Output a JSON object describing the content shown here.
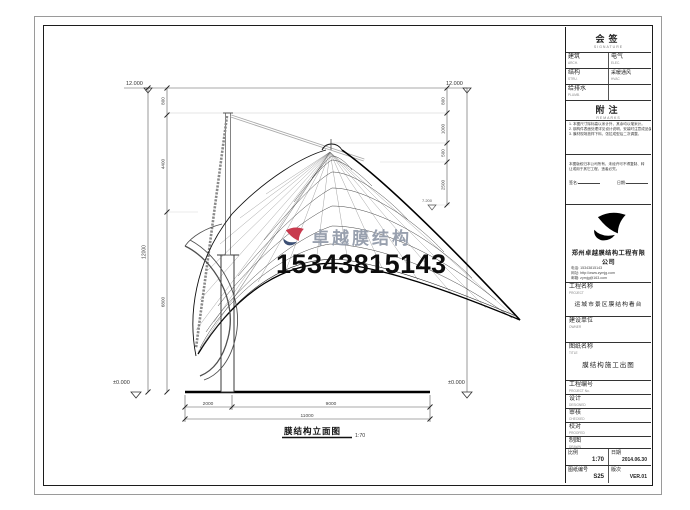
{
  "sheet": {
    "watermark": {
      "brand": "卓越膜结构",
      "phone": "15343815143",
      "logo_red": "#c83a4e",
      "logo_blue": "#3c4f74"
    },
    "view": {
      "title": "膜结构立面图",
      "scale": "1:70"
    },
    "dims": {
      "left_total": "12000",
      "left_segments": [
        "800",
        "4400",
        "6800"
      ],
      "right_segments": [
        "800",
        "1000",
        "500",
        "2500"
      ],
      "right_level": "7.200",
      "bottom_segments": [
        "2000",
        "9000"
      ],
      "bottom_total": "11000",
      "top_level_left": "12.000",
      "top_level_right": "12.000",
      "ground_level_left": "±0.000",
      "ground_level_right": "±0.000"
    },
    "titleblock": {
      "signoff": {
        "title": "会签",
        "sub": "SIGNATURE",
        "rows": [
          {
            "l": "建筑",
            "ls": "ARCH.",
            "r": "电气",
            "rs": "ELEC."
          },
          {
            "l": "结构",
            "ls": "STRU.",
            "r": "采暖通风",
            "rs": "HVAC"
          },
          {
            "l": "给排水",
            "ls": "PLUMB.",
            "r": "",
            "rs": ""
          }
        ]
      },
      "notes": {
        "title": "附注",
        "sub": "REMARKS",
        "lines": [
          "1. 本图尺寸除标高以米计外，其余均以毫米计。",
          "2. 钢构件表面处理详见设计说明，安装时注意成品保护。",
          "3. 膜材现场放样下料，张拉成型后二次调整。"
        ]
      },
      "statement": {
        "text": "本图版权归本公司所有，未经许可不得复制、转让或用于其它工程，违者必究。",
        "sign": "签名:",
        "date": "日期:"
      },
      "company": {
        "name": "郑州卓越膜结构工程有限公司",
        "tel": "电话: 15343815143",
        "web": "网址: http://www.zymjg.com",
        "mail": "邮箱: zymjg@163.com"
      },
      "project": {
        "label": "工程名称",
        "sub": "PROJECT",
        "value": "运城市景区膜结构看台"
      },
      "owner": {
        "label": "建设单位",
        "sub": "OWNER",
        "value": ""
      },
      "drawing": {
        "label": "图纸名称",
        "sub": "TITLE",
        "value": "膜结构施工出图"
      },
      "project_no": {
        "label": "工程编号",
        "sub": "PROJECT No.",
        "value": ""
      },
      "designed": {
        "label": "设计",
        "sub": "DESIGNED"
      },
      "checked": {
        "label": "审核",
        "sub": "CHECKED"
      },
      "proofed": {
        "label": "校对",
        "sub": "PROOFED"
      },
      "drawn": {
        "label": "制图",
        "sub": "DRAWN"
      },
      "scale": {
        "label": "比例",
        "sub": "SCALE",
        "value": "1:70"
      },
      "date": {
        "label": "日期",
        "sub": "DATE",
        "value": "2014.06.30"
      },
      "dwg_no": {
        "label": "图纸编号",
        "sub": "DWG No.",
        "value": "S25"
      },
      "version": {
        "label": "版次",
        "sub": "VER.",
        "value": "VER.01"
      }
    }
  }
}
